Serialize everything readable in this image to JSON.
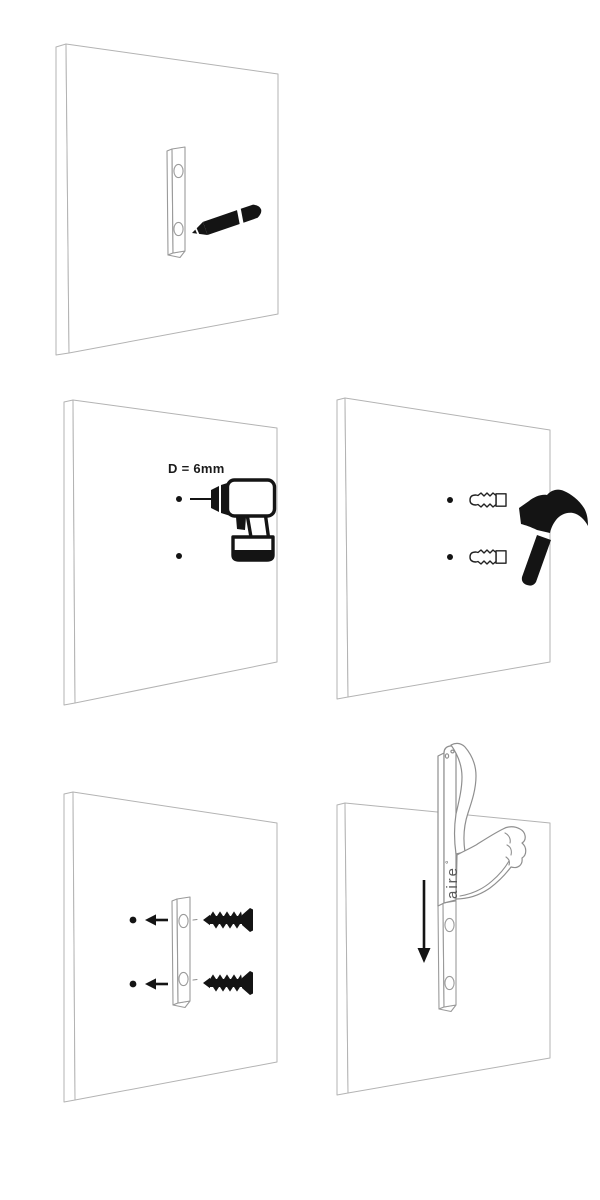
{
  "colors": {
    "background": "#ffffff",
    "wall_line": "#b3b3b3",
    "hardware_line": "#9a9a9a",
    "product_line": "#8f8f8f",
    "ink": "#141414",
    "label": "#1a1a1a",
    "brand": "#5a5a5a"
  },
  "panels": {
    "mark": {
      "icons": [
        "pencil-icon",
        "mounting-bracket"
      ],
      "holes_marked": 2
    },
    "drill": {
      "label": "D = 6mm",
      "icons": [
        "drill-icon"
      ],
      "holes_marked": 2
    },
    "anchor": {
      "icons": [
        "wall-plug-icon",
        "wall-plug-icon",
        "hammer-icon"
      ],
      "holes_marked": 2
    },
    "screw": {
      "icons": [
        "arrow-left-icon",
        "arrow-left-icon",
        "screw-icon",
        "screw-icon",
        "mounting-bracket"
      ],
      "holes_marked": 2
    },
    "hang": {
      "brand": "aire",
      "brand_mark": "°",
      "icons": [
        "arrow-down-icon",
        "hand-hook-product",
        "mounting-bracket"
      ]
    }
  }
}
